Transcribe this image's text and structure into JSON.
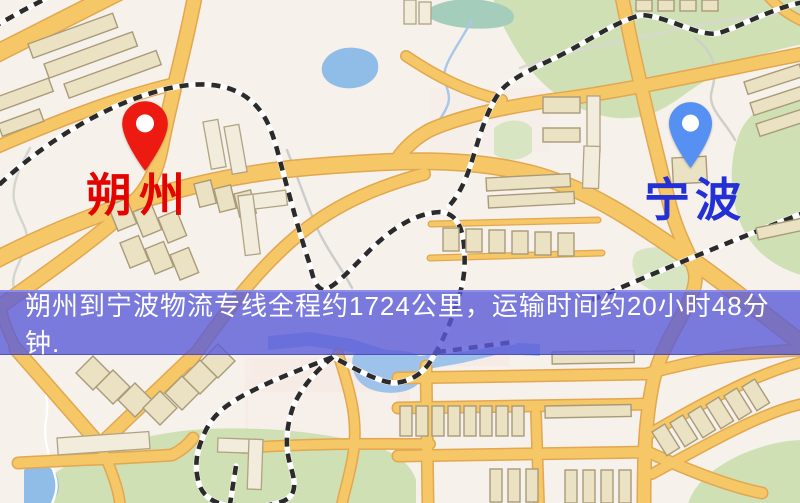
{
  "page": {
    "width": 800,
    "height": 503,
    "kind": "logistics route map image"
  },
  "map": {
    "origin": {
      "name": "朔州",
      "label_color": "#e30400",
      "pin_color": "#ec1a10"
    },
    "destination": {
      "name": "宁波",
      "label_color": "#2330d6",
      "pin_color": "#5590f2"
    },
    "banner": {
      "text": "朔州到宁波物流专线全程约1724公里，运输时间约20小时48分钟.",
      "background_color": "#5b5bd8",
      "text_color": "#ffffff"
    },
    "route": {
      "distance_km": 1724,
      "duration_text": "20小时48分钟"
    },
    "palette": {
      "background": "#f6f1ea",
      "road_fill": "#f6c766",
      "road_casing": "#e2a750",
      "park_green": "#cfe0b4",
      "water_blue": "#8fbde8",
      "pond_teal": "#a5cdbb",
      "railway_dark": "#2b2b2b",
      "building_tan": "#ebe2c3"
    }
  }
}
